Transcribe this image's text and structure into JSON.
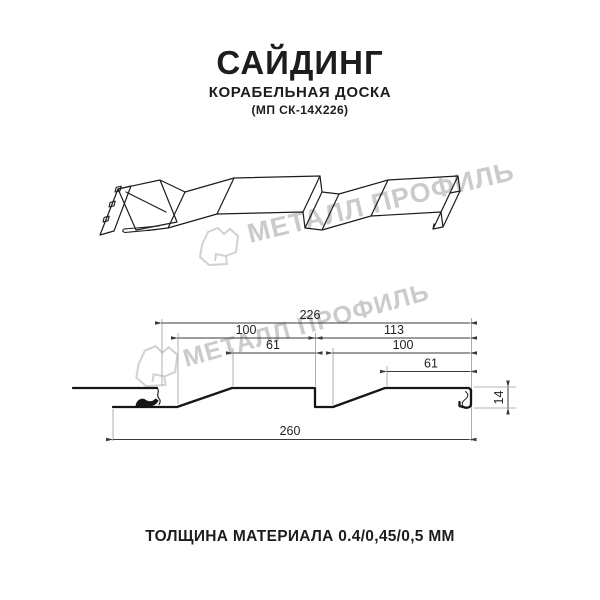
{
  "header": {
    "title": "САЙДИНГ",
    "subtitle": "КОРАБЕЛЬНАЯ ДОСКА",
    "model": "(МП СК-14Х226)"
  },
  "watermark": {
    "brand": "МЕТАЛЛ ПРОФИЛЬ",
    "color": "#cbcbcb"
  },
  "drawing": {
    "type": "siding panel profile — 3d view and cross-section with dimensions",
    "colors": {
      "profile_line": "#161616",
      "dimension_line": "#3a3a3a",
      "extension_line": "#9b9b9b"
    },
    "dims": {
      "module": {
        "label": "226"
      },
      "plank1_full": {
        "label": "100"
      },
      "plank1_top": {
        "label": "61"
      },
      "plank2_full": {
        "label": "113"
      },
      "plank2_mid": {
        "label": "100"
      },
      "plank2_top": {
        "label": "61"
      },
      "overall": {
        "label": "260"
      },
      "height": {
        "label": "14"
      }
    }
  },
  "footer": {
    "text": "ТОЛЩИНА МАТЕРИАЛА 0.4/0,45/0,5 ММ"
  }
}
